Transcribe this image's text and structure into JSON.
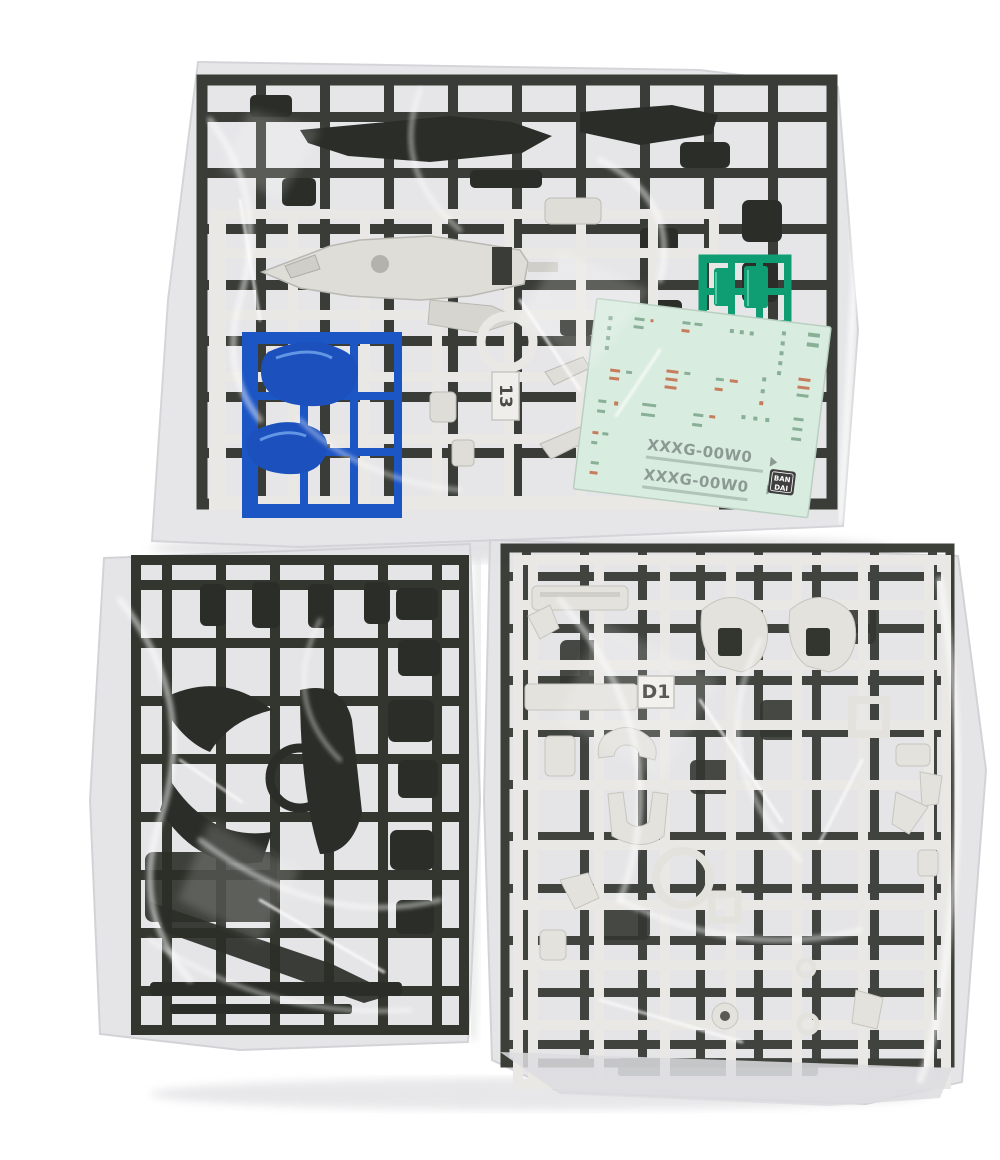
{
  "photo": {
    "top_bag": {
      "runner_tag": "13",
      "decal_sheet": {
        "model_code_line1": "XXXG-00W0",
        "model_code_line2": "XXXG-00W0",
        "brand_line1": "BAN",
        "brand_line2": "DAI"
      }
    },
    "bottom_right_bag": {
      "runner_tag": "D1"
    }
  },
  "colors": {
    "background": "#ffffff",
    "bag_plastic": "#e4e4e7",
    "dark_runner": "#3a3d37",
    "dark_part": "#2b2e28",
    "white_runner": "#e9e8e4",
    "white_part": "#e3e2dd",
    "clear_blue": "#1b50bd",
    "clear_green": "#0f9e74",
    "decal_sheet": "#d9ece0",
    "decal_code_text": "#8b9b93",
    "decal_mark_green": "#7fa88f",
    "decal_mark_red": "#c4704f",
    "bandai_logo_bg": "#3f3f3f",
    "bandai_logo_text": "#ffffff"
  }
}
